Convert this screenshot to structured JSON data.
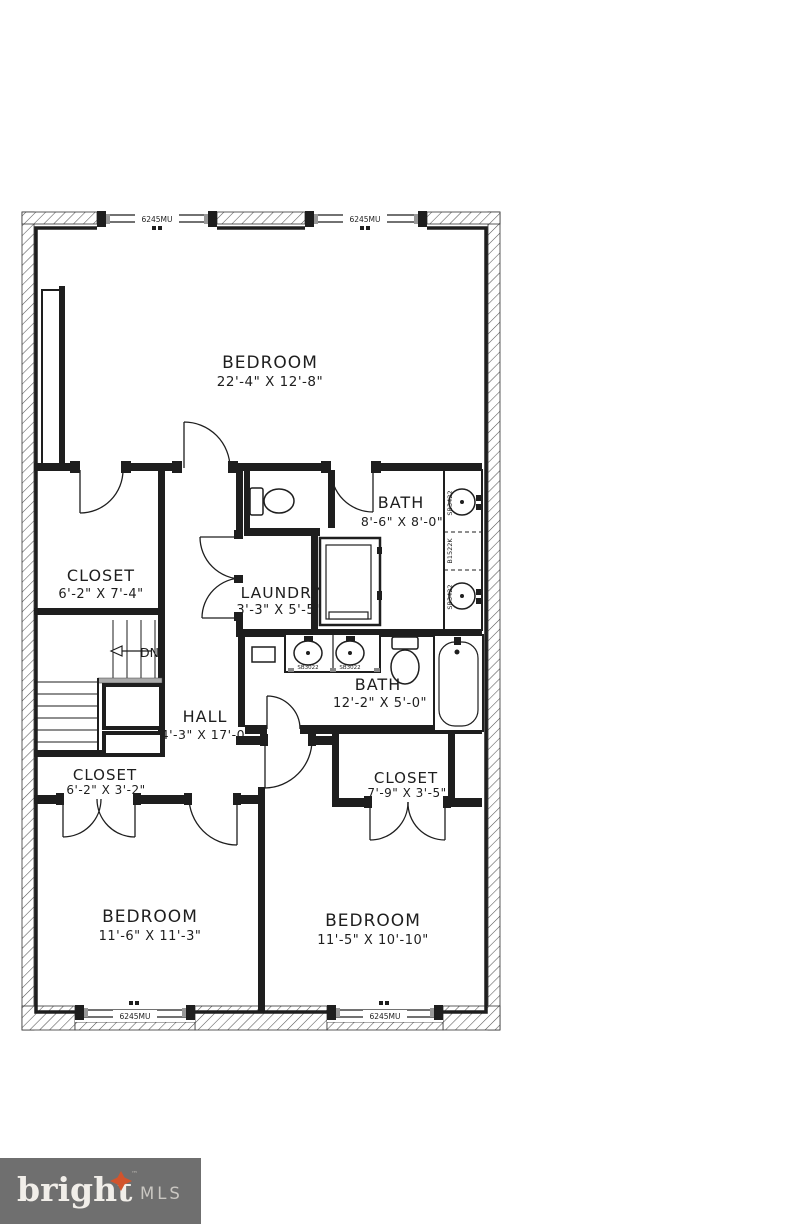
{
  "floorplan": {
    "rooms": [
      {
        "name": "BEDROOM",
        "dims": "22'-4\" X 12'-8\""
      },
      {
        "name": "CLOSET",
        "dims": "6'-2\" X 7'-4\""
      },
      {
        "name": "BATH",
        "dims": "8'-6\" X 8'-0\""
      },
      {
        "name": "LAUNDRY",
        "dims": "3'-3\" X 5'-5\""
      },
      {
        "name": "BATH",
        "dims": "12'-2\" X 5'-0\""
      },
      {
        "name": "HALL",
        "dims": "4'-3\" X 17'-0\""
      },
      {
        "name": "CLOSET",
        "dims": "6'-2\" X 3'-2\""
      },
      {
        "name": "CLOSET",
        "dims": "7'-9\" X 3'-5\""
      },
      {
        "name": "BEDROOM",
        "dims": "11'-6\" X 11'-3\""
      },
      {
        "name": "BEDROOM",
        "dims": "11'-5\" X 10'-10\""
      }
    ],
    "stairs": {
      "label": "DN"
    },
    "window_label": "6245MU",
    "fixtures": {
      "vanity_sink": "SB3422",
      "vanity_cabinet": "B1522K",
      "double_sink": "SB3022"
    }
  },
  "logo": {
    "brand": "bright",
    "tm": "™",
    "suffix": "MLS"
  },
  "colors": {
    "line": "#1e1e1e",
    "logo_bg": "#6f6f6f",
    "logo_star": "#d2542c",
    "logo_brand": "#f1eee9",
    "logo_tm": "#b5b2ad",
    "logo_suffix": "#cac7c2"
  }
}
